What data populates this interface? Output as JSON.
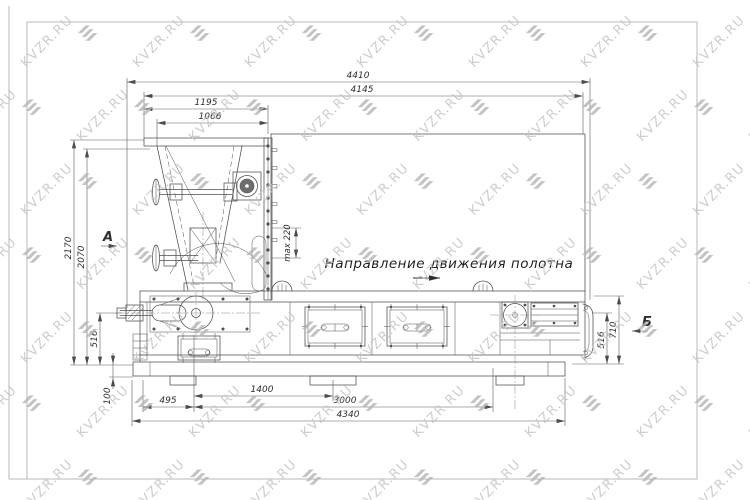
{
  "watermark": {
    "text": "KVZR.RU"
  },
  "colors": {
    "line": "#4f4f4f",
    "dim_line": "#5c5c5c",
    "text": "#2e2e2e",
    "frame": "#b9b9b9",
    "watermark_text": "#c2c2c2",
    "watermark_logo": "#b5b5b5"
  },
  "drawing": {
    "labels": {
      "direction": "Направление движения полотна",
      "view_a": "А",
      "view_b": "Б",
      "max_gap": "max 220"
    },
    "dims": {
      "top": [
        "4410",
        "4145",
        "1195",
        "1066"
      ],
      "left": [
        "2170",
        "2070",
        "516",
        "100"
      ],
      "bottom": [
        "495",
        "1400",
        "3000",
        "4340"
      ],
      "right": [
        "516",
        "710"
      ]
    }
  }
}
